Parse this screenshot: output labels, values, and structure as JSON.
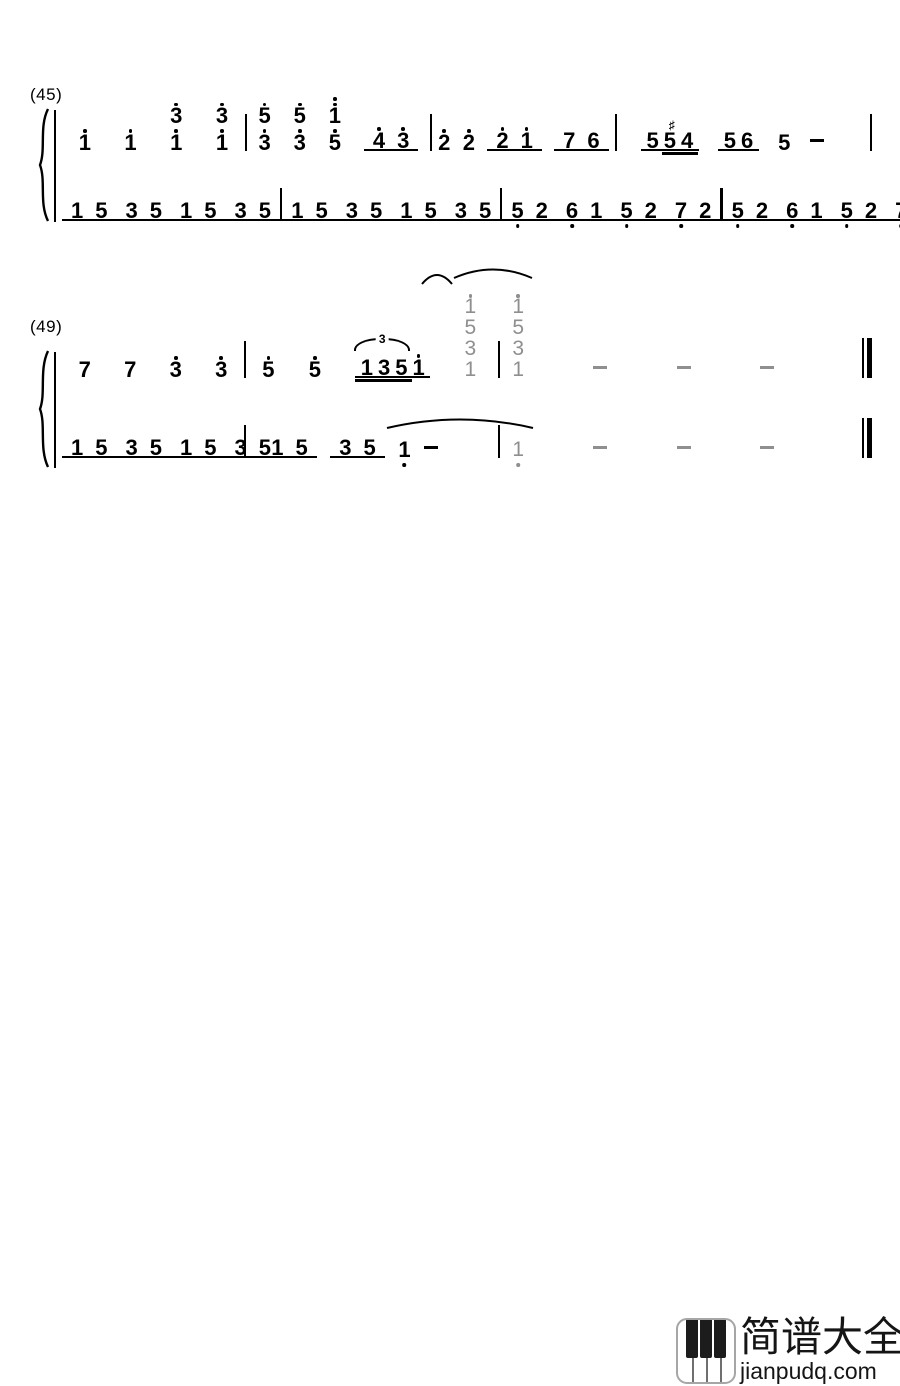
{
  "page": {
    "background": "#ffffff",
    "ink": "#000000",
    "gray": "#8f8f8f"
  },
  "score": {
    "systems": [
      {
        "label": "(45)",
        "final_bar": "bar",
        "melody": {
          "measures": [
            [
              {
                "cells": [
                  {
                    "d": "1",
                    "oa": 1
                  }
                ]
              },
              {
                "cells": [
                  {
                    "d": "1",
                    "oa": 1
                  }
                ]
              },
              {
                "cells": [
                  {
                    "d": "3",
                    "oa": 1
                  },
                  {
                    "d": "1",
                    "oa": 1
                  }
                ]
              },
              {
                "cells": [
                  {
                    "d": "3",
                    "oa": 1
                  },
                  {
                    "d": "1",
                    "oa": 1
                  }
                ]
              }
            ],
            [
              {
                "cells": [
                  {
                    "d": "5",
                    "oa": 1
                  },
                  {
                    "d": "3",
                    "oa": 1
                  }
                ]
              },
              {
                "cells": [
                  {
                    "d": "5",
                    "oa": 1
                  },
                  {
                    "d": "3",
                    "oa": 1
                  }
                ]
              },
              {
                "cells": [
                  {
                    "d": "1",
                    "oa": 2
                  },
                  {
                    "d": "5",
                    "oa": 1
                  }
                ]
              },
              {
                "grp": [
                  {
                    "cells": [
                      {
                        "d": "4",
                        "oa": 1
                      }
                    ]
                  },
                  {
                    "cells": [
                      {
                        "d": "3",
                        "oa": 1
                      }
                    ]
                  }
                ]
              }
            ],
            [
              {
                "cells": [
                  {
                    "d": "2",
                    "oa": 1
                  }
                ]
              },
              {
                "cells": [
                  {
                    "d": "2",
                    "oa": 1
                  }
                ]
              },
              {
                "grp": [
                  {
                    "cells": [
                      {
                        "d": "2",
                        "oa": 1
                      }
                    ]
                  },
                  {
                    "cells": [
                      {
                        "d": "1",
                        "oa": 1
                      }
                    ]
                  }
                ]
              },
              {
                "grp": [
                  {
                    "cells": [
                      {
                        "d": "7"
                      }
                    ]
                  },
                  {
                    "cells": [
                      {
                        "d": "6"
                      }
                    ]
                  }
                ]
              }
            ],
            [
              {
                "grp": [
                  {
                    "cells": [
                      {
                        "d": "5"
                      }
                    ]
                  },
                  {
                    "cells": [
                      {
                        "d": "5",
                        "acc": "♯"
                      }
                    ]
                  },
                  {
                    "cells": [
                      {
                        "d": "4"
                      }
                    ]
                  }
                ],
                "dbl": [
                  "36%",
                  "1%"
                ],
                "cls": "tight"
              },
              {
                "grp": [
                  {
                    "cells": [
                      {
                        "d": "5"
                      }
                    ]
                  },
                  {
                    "cells": [
                      {
                        "d": "6"
                      }
                    ]
                  }
                ],
                "cls": "tight"
              },
              {
                "cells": [
                  {
                    "d": "5"
                  }
                ]
              },
              {
                "dash": true
              }
            ]
          ]
        },
        "bass": {
          "measures": [
            [
              {
                "grp": [
                  {
                    "cells": [
                      {
                        "d": "1"
                      }
                    ]
                  },
                  {
                    "cells": [
                      {
                        "d": "5"
                      }
                    ]
                  }
                ]
              },
              {
                "grp": [
                  {
                    "cells": [
                      {
                        "d": "3"
                      }
                    ]
                  },
                  {
                    "cells": [
                      {
                        "d": "5"
                      }
                    ]
                  }
                ]
              },
              {
                "grp": [
                  {
                    "cells": [
                      {
                        "d": "1"
                      }
                    ]
                  },
                  {
                    "cells": [
                      {
                        "d": "5"
                      }
                    ]
                  }
                ]
              },
              {
                "grp": [
                  {
                    "cells": [
                      {
                        "d": "3"
                      }
                    ]
                  },
                  {
                    "cells": [
                      {
                        "d": "5"
                      }
                    ]
                  }
                ]
              }
            ],
            [
              {
                "grp": [
                  {
                    "cells": [
                      {
                        "d": "1"
                      }
                    ]
                  },
                  {
                    "cells": [
                      {
                        "d": "5"
                      }
                    ]
                  }
                ]
              },
              {
                "grp": [
                  {
                    "cells": [
                      {
                        "d": "3"
                      }
                    ]
                  },
                  {
                    "cells": [
                      {
                        "d": "5"
                      }
                    ]
                  }
                ]
              },
              {
                "grp": [
                  {
                    "cells": [
                      {
                        "d": "1"
                      }
                    ]
                  },
                  {
                    "cells": [
                      {
                        "d": "5"
                      }
                    ]
                  }
                ]
              },
              {
                "grp": [
                  {
                    "cells": [
                      {
                        "d": "3"
                      }
                    ]
                  },
                  {
                    "cells": [
                      {
                        "d": "5"
                      }
                    ]
                  }
                ]
              }
            ],
            [
              {
                "grp": [
                  {
                    "cells": [
                      {
                        "d": "5"
                      }
                    ],
                    "ob": 1
                  },
                  {
                    "cells": [
                      {
                        "d": "2"
                      }
                    ]
                  }
                ]
              },
              {
                "grp": [
                  {
                    "cells": [
                      {
                        "d": "6"
                      }
                    ],
                    "ob": 1
                  },
                  {
                    "cells": [
                      {
                        "d": "1"
                      }
                    ]
                  }
                ]
              },
              {
                "grp": [
                  {
                    "cells": [
                      {
                        "d": "5"
                      }
                    ],
                    "ob": 1
                  },
                  {
                    "cells": [
                      {
                        "d": "2"
                      }
                    ]
                  }
                ]
              },
              {
                "grp": [
                  {
                    "cells": [
                      {
                        "d": "7"
                      }
                    ],
                    "ob": 1
                  },
                  {
                    "cells": [
                      {
                        "d": "2"
                      }
                    ]
                  }
                ]
              }
            ],
            [
              {
                "grp": [
                  {
                    "cells": [
                      {
                        "d": "5"
                      }
                    ],
                    "ob": 1
                  },
                  {
                    "cells": [
                      {
                        "d": "2"
                      }
                    ]
                  }
                ]
              },
              {
                "grp": [
                  {
                    "cells": [
                      {
                        "d": "6"
                      }
                    ],
                    "ob": 1
                  },
                  {
                    "cells": [
                      {
                        "d": "1"
                      }
                    ]
                  }
                ]
              },
              {
                "grp": [
                  {
                    "cells": [
                      {
                        "d": "5"
                      }
                    ],
                    "ob": 1
                  },
                  {
                    "cells": [
                      {
                        "d": "2"
                      }
                    ]
                  }
                ]
              },
              {
                "grp": [
                  {
                    "cells": [
                      {
                        "d": "7"
                      }
                    ],
                    "ob": 1
                  },
                  {
                    "cells": [
                      {
                        "d": "2"
                      }
                    ]
                  }
                ]
              }
            ]
          ]
        }
      },
      {
        "label": "(49)",
        "final_bar": "final",
        "melody": {
          "measures": [
            [
              {
                "cells": [
                  {
                    "d": "7"
                  }
                ]
              },
              {
                "cells": [
                  {
                    "d": "7"
                  }
                ]
              },
              {
                "cells": [
                  {
                    "d": "3",
                    "oa": 1
                  }
                ]
              },
              {
                "cells": [
                  {
                    "d": "3",
                    "oa": 1
                  }
                ]
              }
            ],
            [
              {
                "cells": [
                  {
                    "d": "5",
                    "oa": 1
                  }
                ]
              },
              {
                "cells": [
                  {
                    "d": "5",
                    "oa": 1
                  }
                ]
              },
              {
                "grp": [
                  {
                    "cells": [
                      {
                        "d": "1"
                      }
                    ]
                  },
                  {
                    "cells": [
                      {
                        "d": "3"
                      }
                    ]
                  },
                  {
                    "cells": [
                      {
                        "d": "5"
                      }
                    ]
                  },
                  {
                    "cells": [
                      {
                        "d": "1",
                        "oa": 1
                      }
                    ]
                  }
                ],
                "dbl": [
                  "0%",
                  "24%"
                ],
                "tri": "3",
                "cls": "tight"
              },
              {
                "cells": [
                  {
                    "d": "1",
                    "oa": 1
                  },
                  {
                    "d": "5"
                  },
                  {
                    "d": "3"
                  },
                  {
                    "d": "1"
                  }
                ],
                "gray": true,
                "cls": "chord"
              }
            ],
            [
              {
                "cells": [
                  {
                    "d": "1",
                    "oa": 1
                  },
                  {
                    "d": "5"
                  },
                  {
                    "d": "3"
                  },
                  {
                    "d": "1"
                  }
                ],
                "gray": true,
                "cls": "chord"
              },
              {
                "dash": true,
                "gray": true
              },
              {
                "dash": true,
                "gray": true
              },
              {
                "dash": true,
                "gray": true
              }
            ]
          ]
        },
        "bass": {
          "measures": [
            [
              {
                "grp": [
                  {
                    "cells": [
                      {
                        "d": "1"
                      }
                    ]
                  },
                  {
                    "cells": [
                      {
                        "d": "5"
                      }
                    ]
                  }
                ]
              },
              {
                "grp": [
                  {
                    "cells": [
                      {
                        "d": "3"
                      }
                    ]
                  },
                  {
                    "cells": [
                      {
                        "d": "5"
                      }
                    ]
                  }
                ]
              },
              {
                "grp": [
                  {
                    "cells": [
                      {
                        "d": "1"
                      }
                    ]
                  },
                  {
                    "cells": [
                      {
                        "d": "5"
                      }
                    ]
                  }
                ]
              },
              {
                "grp": [
                  {
                    "cells": [
                      {
                        "d": "3"
                      }
                    ]
                  },
                  {
                    "cells": [
                      {
                        "d": "5"
                      }
                    ]
                  }
                ]
              }
            ],
            [
              {
                "grp": [
                  {
                    "cells": [
                      {
                        "d": "1"
                      }
                    ]
                  },
                  {
                    "cells": [
                      {
                        "d": "5"
                      }
                    ]
                  }
                ]
              },
              {
                "grp": [
                  {
                    "cells": [
                      {
                        "d": "3"
                      }
                    ]
                  },
                  {
                    "cells": [
                      {
                        "d": "5"
                      }
                    ]
                  }
                ]
              },
              {
                "cells": [
                  {
                    "d": "1"
                  }
                ],
                "ob": 1
              },
              {
                "dash": true
              }
            ],
            [
              {
                "cells": [
                  {
                    "d": "1"
                  }
                ],
                "ob": 1,
                "gray": true
              },
              {
                "dash": true,
                "gray": true
              },
              {
                "dash": true,
                "gray": true
              },
              {
                "dash": true,
                "gray": true
              }
            ]
          ]
        }
      }
    ]
  },
  "watermark": {
    "site_name": "简谱大全",
    "site_url": "jianpudq.com",
    "icon": "piano-keys-icon"
  }
}
